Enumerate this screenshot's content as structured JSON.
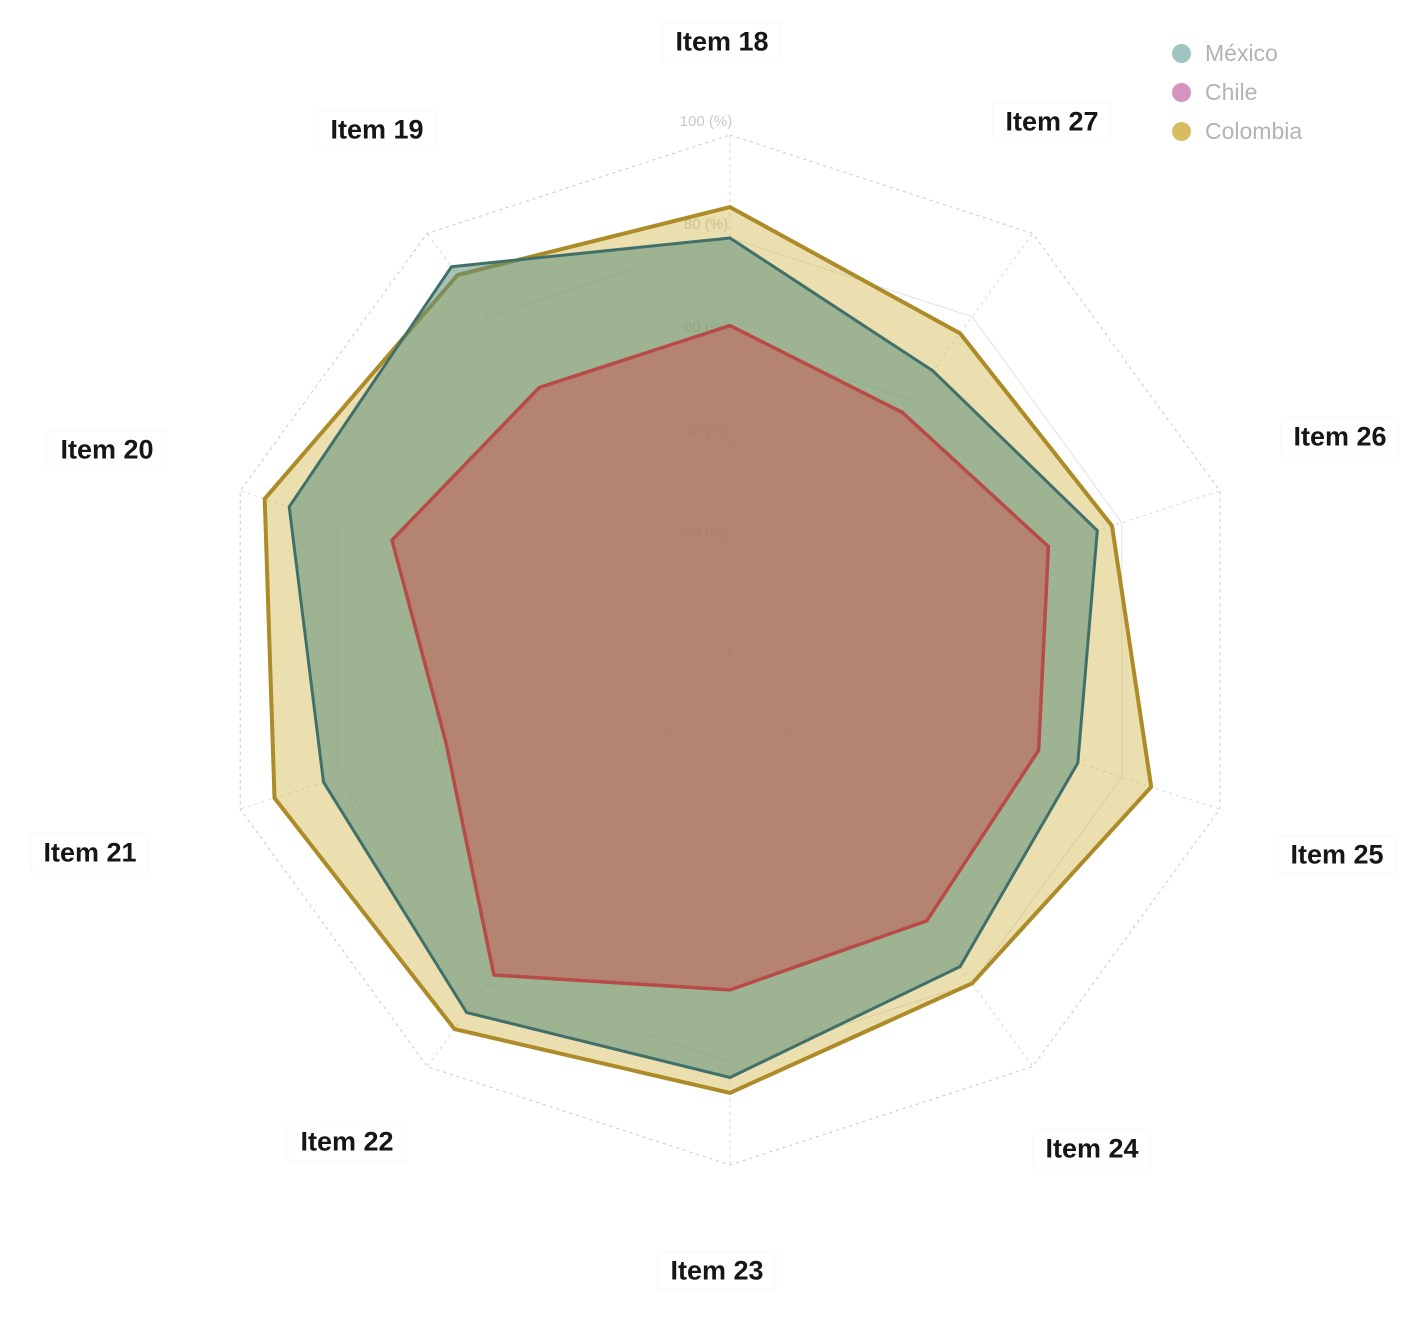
{
  "legend": {
    "items": [
      {
        "label": "México",
        "swatch_color": "#9fc5c1"
      },
      {
        "label": "Chile",
        "swatch_color": "#d593be"
      },
      {
        "label": "Colombia",
        "swatch_color": "#d8bd60"
      }
    ]
  },
  "chart_data": {
    "type": "radar",
    "axes": [
      "Item 18",
      "Item 27",
      "Item 26",
      "Item 25",
      "Item 24",
      "Item 23",
      "Item 22",
      "Item 21",
      "Item 20",
      "Item 19"
    ],
    "radial_ticks": [
      "20 (%)",
      "40 (%)",
      "60 (%)",
      "80 (%)",
      "100 (%)"
    ],
    "rmax": 100,
    "r_interval": 20,
    "grid": "dashed-decagon-web",
    "legend_position": "top-right",
    "series": [
      {
        "name": "México",
        "values": [
          80,
          67,
          75,
          71,
          76,
          83,
          87,
          83,
          90,
          92
        ],
        "line_color": "#41706a",
        "fill_color": "#5f8f7a",
        "fill_opacity": 0.55
      },
      {
        "name": "Chile",
        "values": [
          63,
          57,
          65,
          63,
          65,
          66,
          78,
          58,
          69,
          63
        ],
        "line_color": "#b84b47",
        "fill_color": "#c4625c",
        "fill_opacity": 0.6
      },
      {
        "name": "Colombia",
        "values": [
          86,
          76,
          78,
          86,
          80,
          86,
          91,
          93,
          95,
          90
        ],
        "line_color": "#ad8b28",
        "fill_color": "#d2b54e",
        "fill_opacity": 0.45
      }
    ]
  }
}
